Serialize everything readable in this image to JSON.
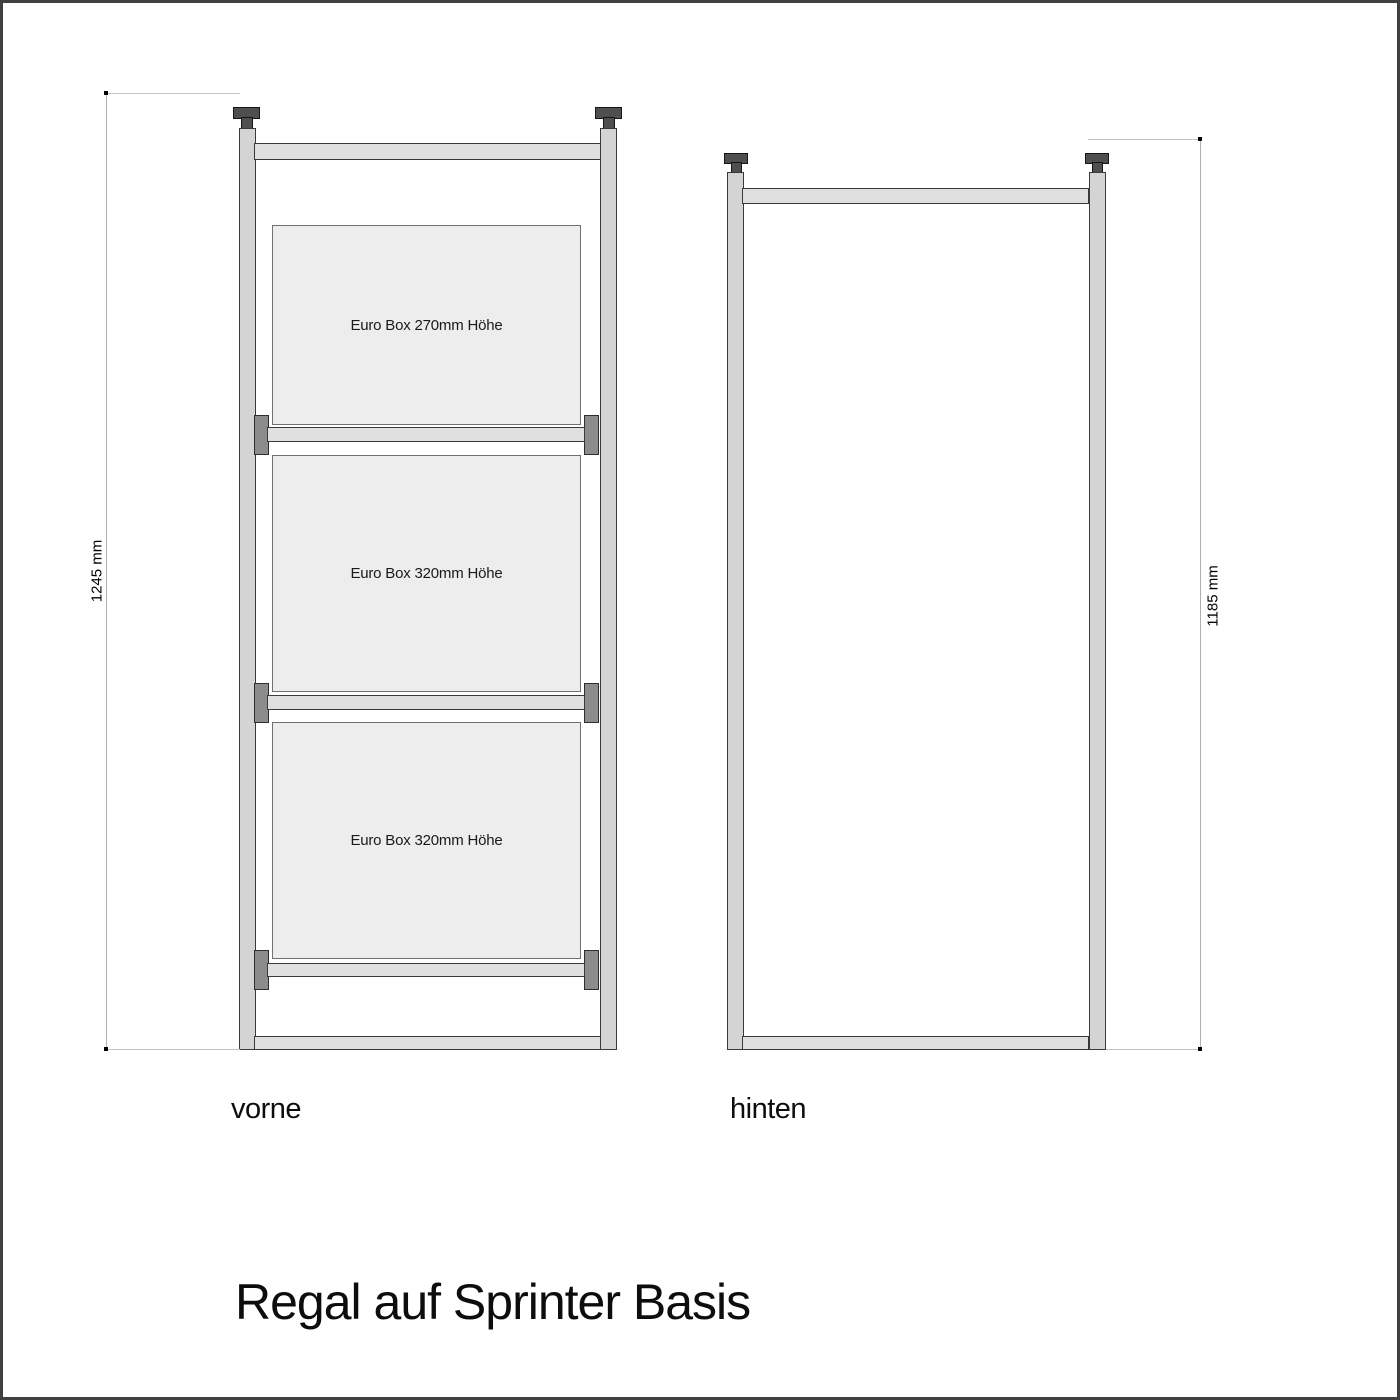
{
  "page": {
    "title": "Regal auf Sprinter Basis",
    "background": "#ffffff",
    "border_color": "#414141"
  },
  "views": {
    "front": {
      "label": "vorne",
      "dimension": "1245 mm",
      "boxes": [
        {
          "label": "Euro Box 270mm Höhe"
        },
        {
          "label": "Euro Box 320mm Höhe"
        },
        {
          "label": "Euro Box 320mm Höhe"
        }
      ]
    },
    "rear": {
      "label": "hinten",
      "dimension": "1185 mm"
    }
  },
  "icons": {
    "screw_knob": "screw-knob-icon"
  },
  "colors": {
    "outline": "#3a3a3a",
    "post_fill": "#d4d4d4",
    "bar_fill": "#e0e0e0",
    "box_fill": "#ededed",
    "bracket_fill": "#8c8c8c",
    "knob_fill": "#4f4f4f",
    "dimension_line": "#b0b0b0",
    "text": "#111111"
  }
}
